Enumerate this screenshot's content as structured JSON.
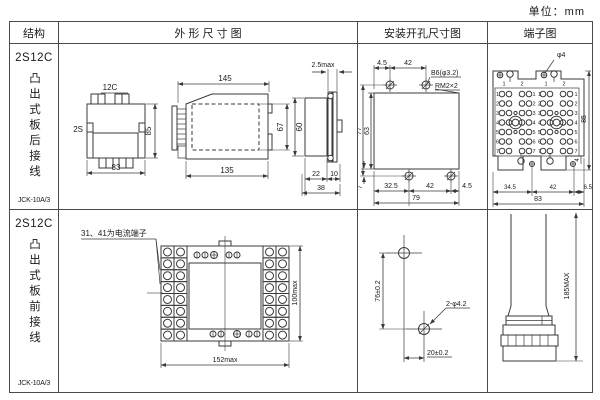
{
  "unit_note": "单位：mm",
  "headers": {
    "structure": "结构",
    "outline": "外 形 尺 寸 图",
    "mounting": "安装开孔尺寸图",
    "terminal": "端子图"
  },
  "rows": [
    {
      "model": "2S12C",
      "mount_type": "凸出式板后接线",
      "code": "JCK-10A/3"
    },
    {
      "model": "2S12C",
      "mount_type": "凸出式板前接线",
      "code": "JCK-10A/3"
    }
  ],
  "row1": {
    "rear": {
      "top_label": "12C",
      "side_label": "2S",
      "height": "85",
      "width": "83"
    },
    "side": {
      "width_total": "145",
      "width_body": "135",
      "height_inner": "67"
    },
    "profile": {
      "thickness": "2.5max",
      "height": "60",
      "w1": "22",
      "w2": "10",
      "w_total": "38"
    },
    "mount": {
      "top_offset": "4.5",
      "top_pitch": "42",
      "hole_label": "B6(φ3.2)",
      "screw_label": "RM2×2",
      "h_total": "77",
      "h_inner": "63",
      "bottom_offset": "7",
      "bottom_d1": "32.5",
      "bottom_d2": "42",
      "bottom_d3": "4.5",
      "bottom_total": "79"
    },
    "term": {
      "hole_label": "φ4",
      "height": "85",
      "offset": "4",
      "bottom_d1": "34.5",
      "bottom_d2": "42",
      "bottom_d3": "6.5",
      "bottom_total": "83",
      "col_nums": [
        "1",
        "2",
        "1",
        "2"
      ],
      "row_nums": [
        "1",
        "2",
        "3",
        "4",
        "5",
        "6",
        "7"
      ]
    }
  },
  "row2": {
    "front": {
      "note": "31、41为电流端子",
      "height": "100max",
      "width": "152max"
    },
    "mount": {
      "v_pitch": "76±0.2",
      "hole_label": "2-φ4.2",
      "h_pitch": "20±0.2"
    },
    "term": {
      "height": "185MAX"
    }
  }
}
